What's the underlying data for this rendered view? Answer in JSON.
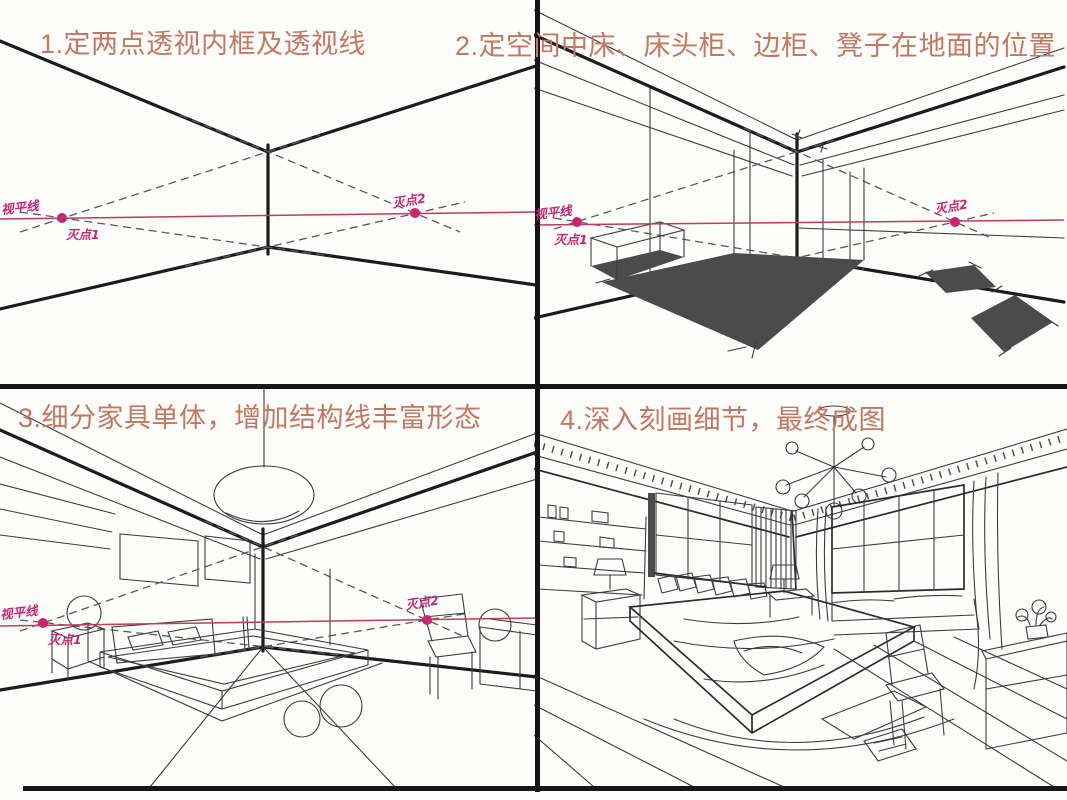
{
  "page_kind": "two-point-perspective bedroom sketch tutorial, 4 steps",
  "colors": {
    "title": "#c5785f",
    "pink": "#c13a60",
    "vp": "#cb2470",
    "ink": "#1c1c1c",
    "dark": "#4b4b4b",
    "bg": "#fdfdfc",
    "border": "#161616"
  },
  "panels": [
    {
      "step": "1",
      "title": "1.定两点透视内框及透视线",
      "annotations": {
        "horizon_label": "视平线",
        "vp1_label": "灭点1",
        "vp2_label": "灭点2"
      }
    },
    {
      "step": "2",
      "title": "2.定空间中床、床头柜、边柜、凳子在地面的位置",
      "annotations": {
        "horizon_label": "视平线",
        "vp1_label": "灭点1",
        "vp2_label": "灭点2"
      }
    },
    {
      "step": "3",
      "title": "3.细分家具单体，增加结构线丰富形态",
      "annotations": {
        "horizon_label": "视平线",
        "vp1_label": "灭点1",
        "vp2_label": "灭点2"
      }
    },
    {
      "step": "4",
      "title": "4.深入刻画细节，最终成图"
    }
  ]
}
